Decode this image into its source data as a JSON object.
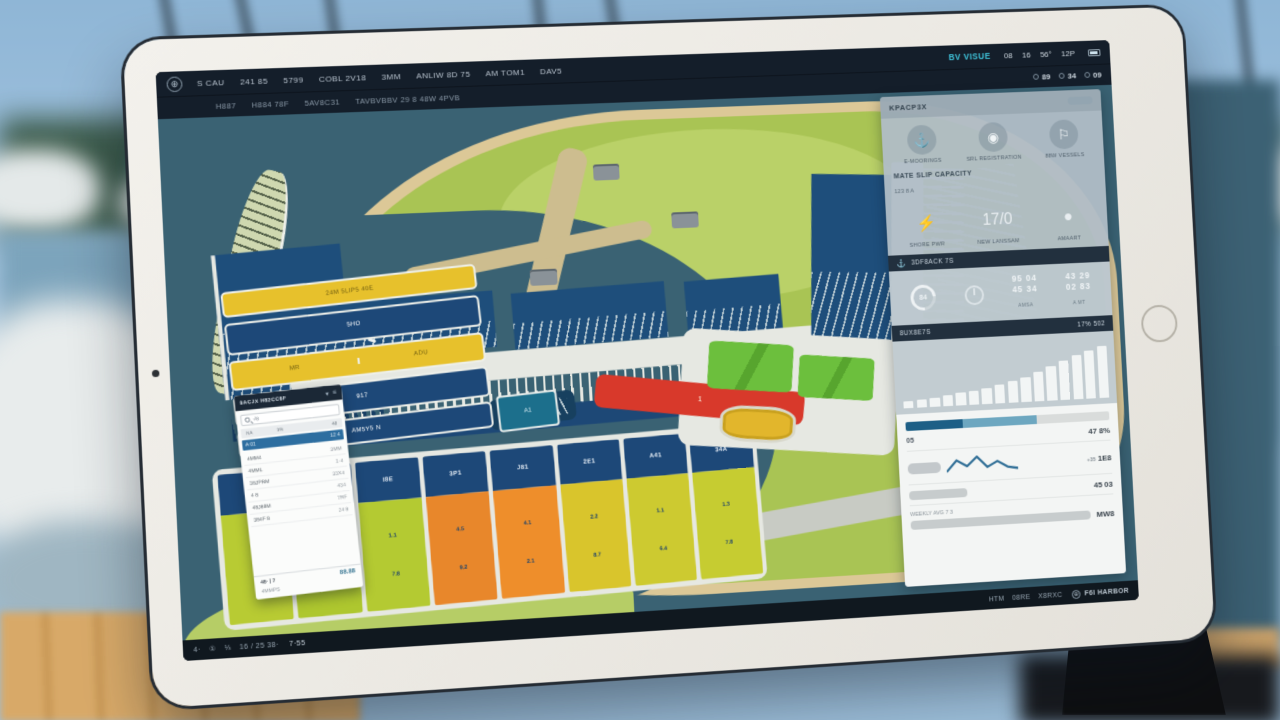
{
  "colors": {
    "accent_blue": "#2d6ea0",
    "cyan_brand": "#3fc2d9",
    "nav_navy": "#141e2a",
    "water": "#3a6273",
    "land_green": "#a9c454",
    "beach_tan": "#dcc897",
    "berth_available": "#b8cb33",
    "berth_occupied": "#e8872b",
    "berth_reserved": "#d9c52c",
    "alert_red": "#d8392b",
    "basin_navy": "#1d4878"
  },
  "top_nav": {
    "logo_glyph": "⊕",
    "row1_items": [
      "S CAU",
      "241 85",
      "5799",
      "COBL 2V18",
      "3MM",
      "ANLIW 8D 75",
      "AM TOM1",
      "DAV5"
    ],
    "brand": "BV VISUE",
    "row1_status": [
      "08",
      "16",
      "56°",
      "12P"
    ],
    "row2_items": [
      "H887",
      "H884 78F",
      "5AV8C31",
      "TAVBVBBV 29 8 48W 4PVB"
    ],
    "row2_stats": [
      "89",
      "34",
      "09"
    ]
  },
  "map": {
    "platform_label": "205 13 | 3 10",
    "pier_label": "2X",
    "dock_labels": [
      "NW K88SPV A8",
      "85",
      "88",
      "JZ8"
    ],
    "red_building_label": "1",
    "buildings": {
      "bar1": "24M 5LIP5 40E",
      "bar2": "5HO",
      "bar3a": "MR",
      "bar3b": "ADU",
      "bar4": "917",
      "bar5": "AM5Y5 N",
      "bar6": "A1"
    },
    "slots": [
      {
        "code": "J4E",
        "a": "2.1",
        "b": "7.4",
        "color": "#b8cb33"
      },
      {
        "code": "S4W",
        "a": "3.3",
        "b": "1.0",
        "color": "#aec72f"
      },
      {
        "code": "I8E",
        "a": "1.1",
        "b": "7.8",
        "color": "#b4ca32"
      },
      {
        "code": "3P1",
        "a": "4.5",
        "b": "9.2",
        "color": "#e8872b"
      },
      {
        "code": "J81",
        "a": "4.1",
        "b": "2.1",
        "color": "#ee8e2b"
      },
      {
        "code": "2E1",
        "a": "2.2",
        "b": "8.7",
        "color": "#d9c52c"
      },
      {
        "code": "A41",
        "a": "1.1",
        "b": "6.4",
        "color": "#cdca30"
      },
      {
        "code": "34A",
        "a": "1.3",
        "b": "7.8",
        "color": "#c6cc31"
      }
    ]
  },
  "sidebar": {
    "title": "KPACP3X",
    "quick_icons": [
      {
        "glyph": "⚓",
        "label": "E-MOORINGS"
      },
      {
        "glyph": "◉",
        "label": "SRL REGISTRATION"
      },
      {
        "glyph": "⚐",
        "label": "88W VESSELS"
      }
    ],
    "section_title": "MATE SLIP CAPACITY",
    "section_sub": "123 8 A",
    "util_icons": [
      {
        "glyph": "⚡",
        "label": "SHORE PWR"
      },
      {
        "glyph": "17/0",
        "label": "NEW LANSSAM"
      },
      {
        "glyph": "●",
        "label": "AMAART"
      }
    ],
    "band1_left": "3DF8ACK 7S",
    "stats": {
      "gauge_value": "84",
      "cols": [
        {
          "top": "95 04",
          "bottom": "45 34",
          "caption": "AMSA"
        },
        {
          "top": "43 29",
          "bottom": "02 83",
          "caption": "A MT"
        }
      ]
    },
    "band2_left": "8UX8E7S",
    "band2_right": "17% 502",
    "bar_chart": {
      "values": [
        12,
        14,
        16,
        18,
        21,
        24,
        27,
        31,
        36,
        42,
        50,
        58,
        66,
        74,
        81,
        88
      ]
    },
    "metrics": {
      "progress": {
        "seg1": 28,
        "seg2": 36
      },
      "row1": {
        "label": "05",
        "value": "47 8%"
      },
      "row2": {
        "sub": "+35",
        "value": "1E8"
      },
      "row3": {
        "value": "45 03"
      },
      "row4": {
        "label": "WEEKLY AVG 7 3",
        "value": "MW8"
      },
      "sparkline": [
        18,
        6,
        13,
        3,
        15,
        9,
        16,
        18
      ]
    }
  },
  "left_panel": {
    "title": "8ACJX H82CC8F",
    "icon1": "▾",
    "icon2": "≡",
    "search_value": "√8",
    "cols": [
      "NA",
      "3%",
      "48"
    ],
    "selected": {
      "n": "A 01",
      "v": "12 4"
    },
    "rows": [
      {
        "n": "4MM4",
        "v": "3MM"
      },
      {
        "n": "4MML",
        "v": "1·4"
      },
      {
        "n": "38JPRM",
        "v": "33X4"
      },
      {
        "n": "4 8",
        "v": "434"
      },
      {
        "n": "48J88M",
        "v": "7RF"
      },
      {
        "n": "384F 8",
        "v": "24 8"
      }
    ],
    "footer_label": "48· | 7",
    "footer_value": "88.88",
    "footer_sub": "4MMPS"
  },
  "status_bar": {
    "left_items": [
      "4·",
      "①",
      "⅓",
      "16 / 25 38·"
    ],
    "time": "7·55",
    "right_items": [
      "HTM",
      "08RE",
      "X8RXC"
    ],
    "brand_glyph": "⊕",
    "brand": "F6I HARBOR"
  }
}
